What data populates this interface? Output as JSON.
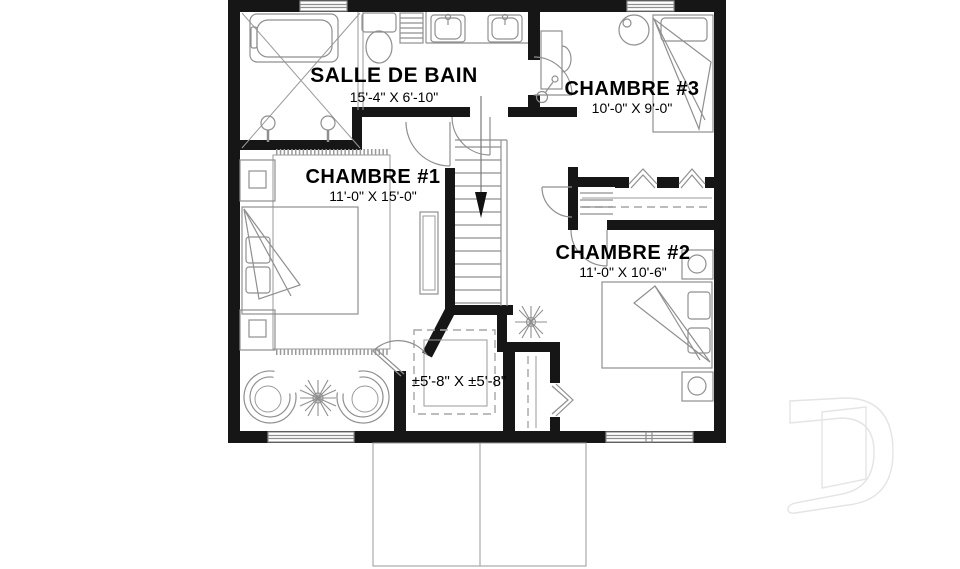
{
  "plan": {
    "title": "second floor plan",
    "rooms": [
      {
        "id": "salle-de-bain",
        "label": "SALLE DE BAIN",
        "dimensions": "15'-4\" X 6'-10\""
      },
      {
        "id": "chambre-3",
        "label": "CHAMBRE #3",
        "dimensions": "10'-0\" X 9'-0\""
      },
      {
        "id": "chambre-1",
        "label": "CHAMBRE #1",
        "dimensions": "11'-0\" X 15'-0\""
      },
      {
        "id": "chambre-2",
        "label": "CHAMBRE #2",
        "dimensions": "11'-0\" X 10'-6\""
      },
      {
        "id": "walk-in",
        "label": "",
        "dimensions": "±5'-8\" X ±5'-8\""
      }
    ],
    "stairs": {
      "direction": "down"
    },
    "fixtures": [
      "bathtub",
      "shower",
      "shower-heads",
      "toilet",
      "towel-ladder",
      "double-vanity-sinks",
      "beds",
      "pillows",
      "folded-blankets",
      "nightstands",
      "rug",
      "dresser",
      "round-chairs",
      "plants",
      "desk",
      "desk-chair",
      "desk-lamp",
      "round-side-table",
      "closet-rods",
      "linen-shelves",
      "bifold-doors",
      "door-swings",
      "windows"
    ],
    "colors": {
      "wall": "#161616",
      "furniture_line": "#8f8f8f",
      "background": "#ffffff",
      "watermark": "#e4e4e4",
      "text": "#000000"
    },
    "watermark_letter": "D"
  }
}
